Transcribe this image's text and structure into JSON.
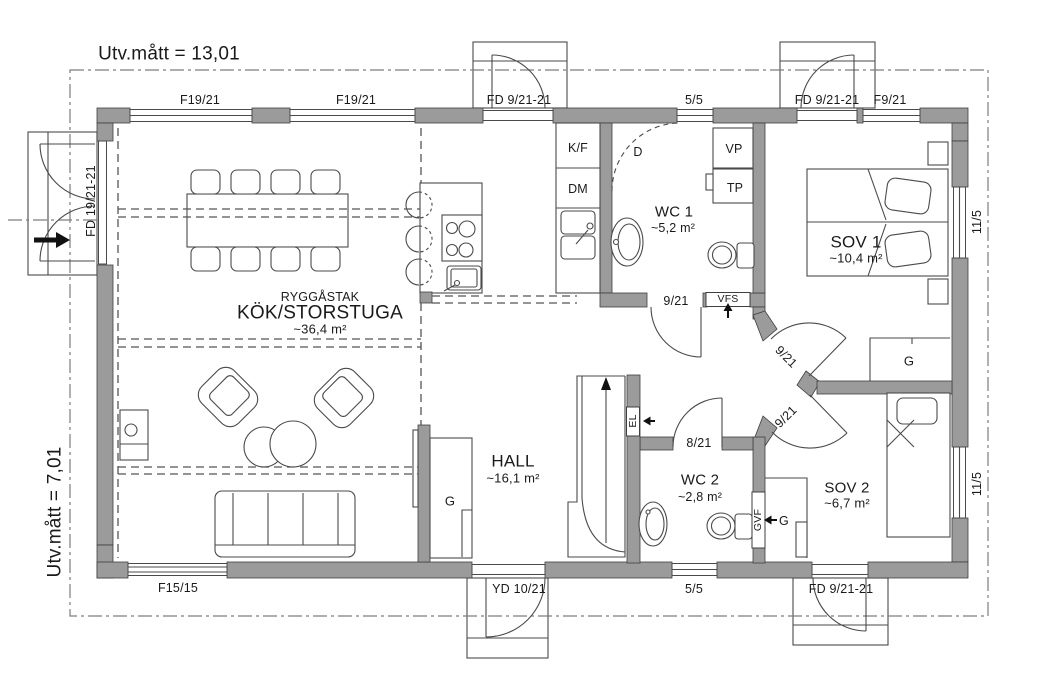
{
  "meta": {
    "width_label": "Utv.mått = 13,01",
    "height_label": "Utv.mått = 7,01"
  },
  "rooms": {
    "kitchen": {
      "note": "RYGGÅSTAK",
      "name": "KÖK/STORSTUGA",
      "area": "~36,4 m²"
    },
    "wc1": {
      "name": "WC 1",
      "area": "~5,2 m²"
    },
    "sov1": {
      "name": "SOV 1",
      "area": "~10,4 m²"
    },
    "hall": {
      "name": "HALL",
      "area": "~16,1 m²"
    },
    "wc2": {
      "name": "WC 2",
      "area": "~2,8 m²"
    },
    "sov2": {
      "name": "SOV 2",
      "area": "~6,7 m²"
    }
  },
  "windows": {
    "f19_21_a": "F19/21",
    "f19_21_b": "F19/21",
    "top_5_5": "5/5",
    "f9_21": "F9/21",
    "sov1_11_5": "11/5",
    "sov2_11_5": "11/5",
    "f15_15": "F15/15",
    "bottom_5_5": "5/5"
  },
  "doors": {
    "front_double": "FD 19/21-21",
    "top_patio": "FD 9/21-21",
    "sov1_patio": "FD 9/21-21",
    "sov2_patio": "FD 9/21-21",
    "yard": "YD 10/21",
    "wc1": "9/21",
    "sov1": "9/21",
    "sov2": "9/21",
    "wc2": "8/21"
  },
  "fixtures": {
    "fridge_freezer": "K/F",
    "dishwasher": "DM",
    "shower": "D",
    "vp": "VP",
    "tp": "TP",
    "vfs": "VFS",
    "el": "EL",
    "gvf": "GVF",
    "wardrobe_hall": "G",
    "wardrobe_sov1": "G",
    "wardrobe_sov2": "G"
  },
  "colors": {
    "wall": "#9b9b9b",
    "line": "#4a4a4a",
    "text": "#1a1a1a"
  }
}
